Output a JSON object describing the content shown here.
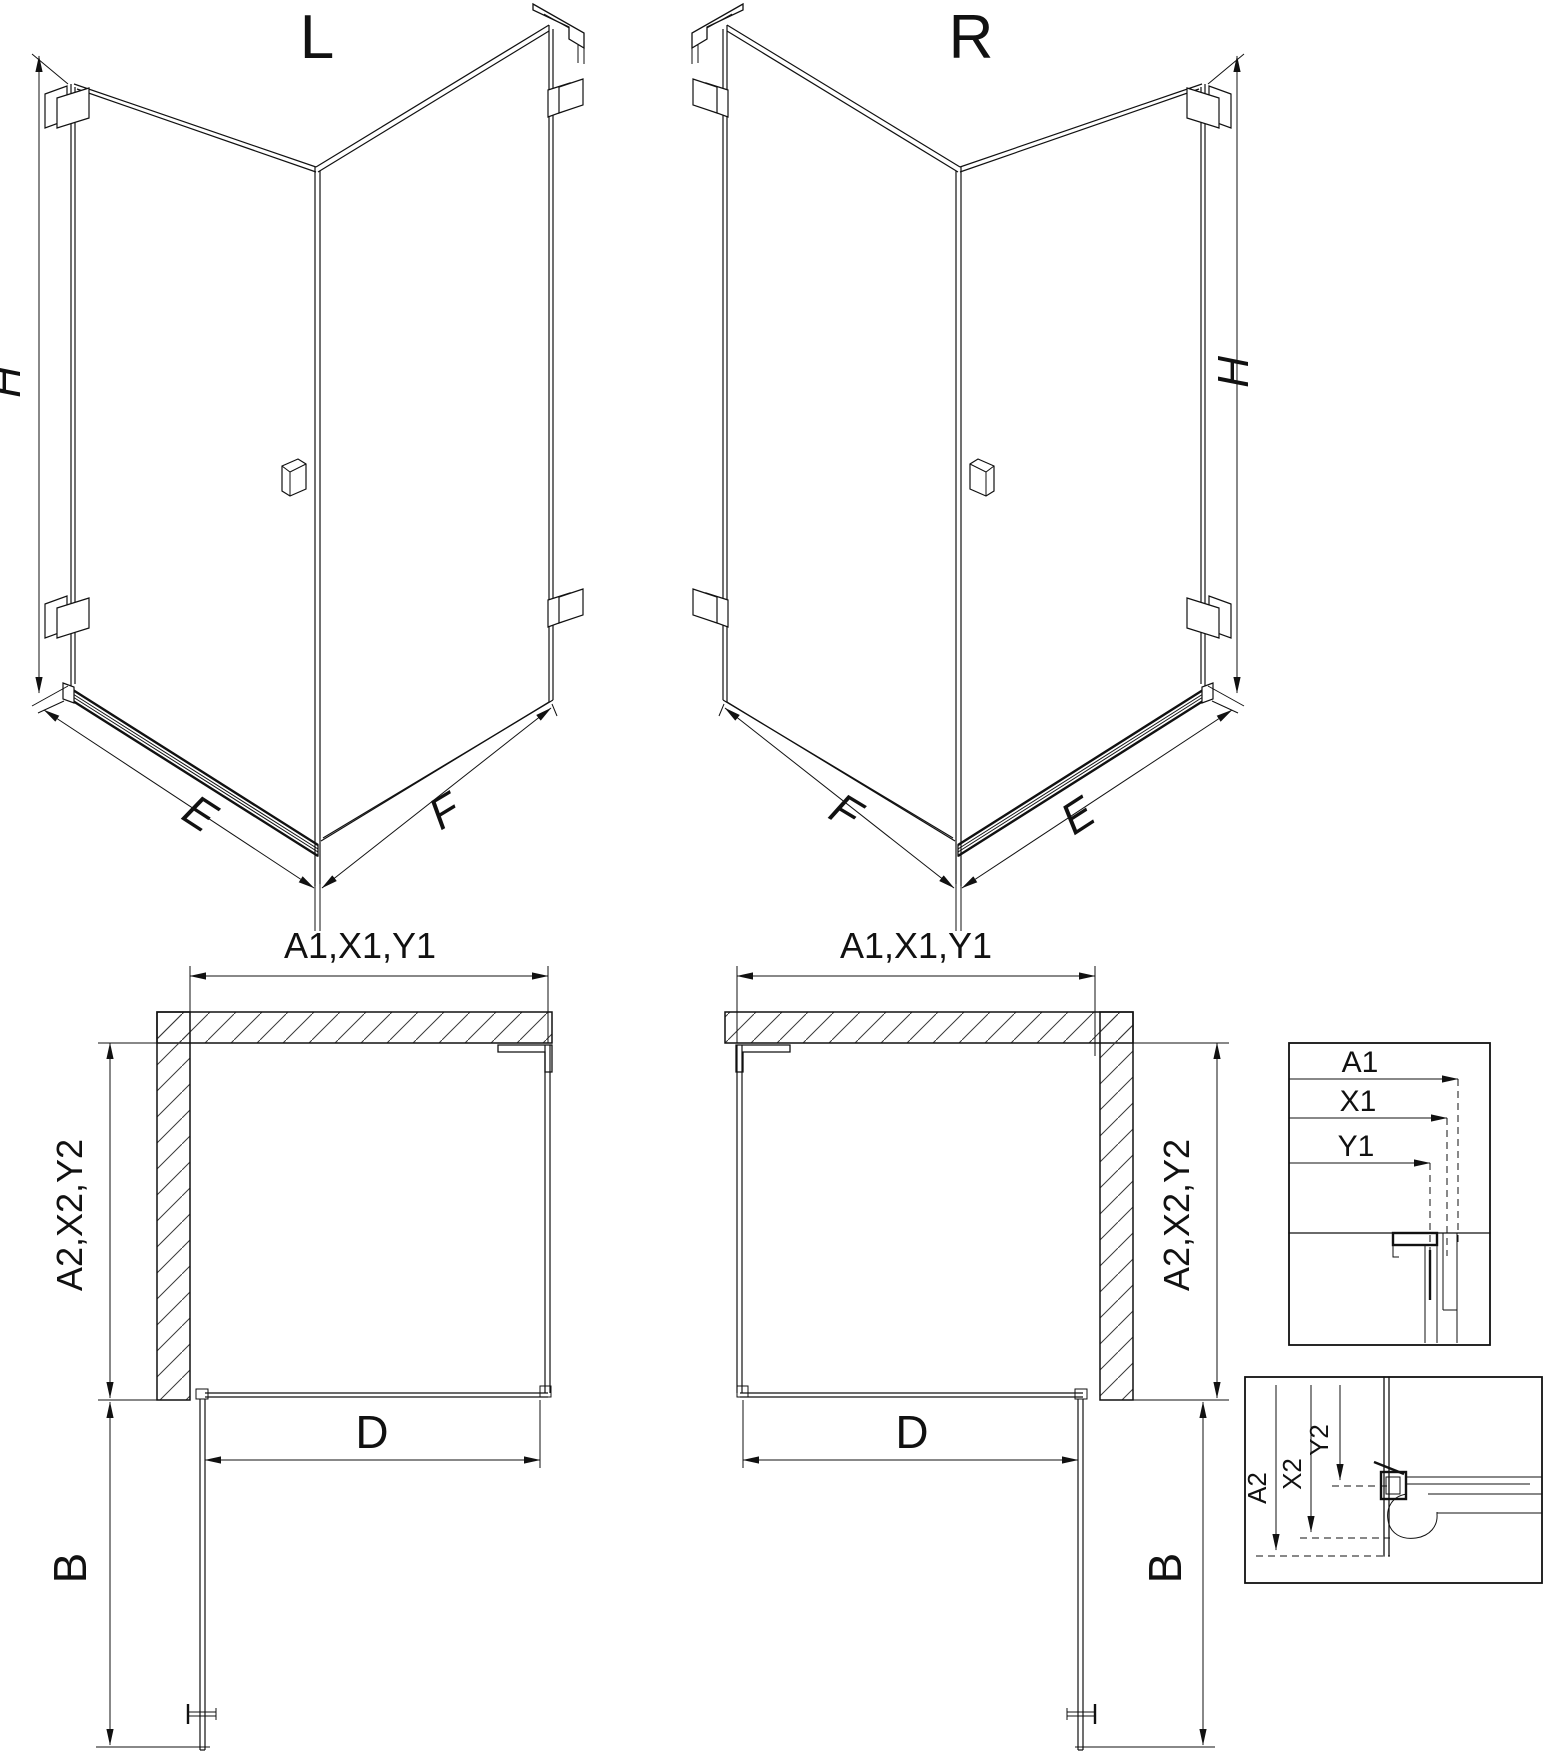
{
  "page": {
    "background": "#ffffff",
    "line_color": "#111111"
  },
  "iso_left": {
    "title": "L",
    "height_label": "H",
    "door_side_label": "E",
    "fixed_side_label": "F"
  },
  "iso_right": {
    "title": "R",
    "height_label": "H",
    "fixed_side_label": "F",
    "door_side_label": "E"
  },
  "plan_left": {
    "top_dim": "A1,X1,Y1",
    "side_dim": "A2,X2,Y2",
    "door_width_dim": "D",
    "door_swing_dim": "B"
  },
  "plan_right": {
    "top_dim": "A1,X1,Y1",
    "side_dim": "A2,X2,Y2",
    "door_width_dim": "D",
    "door_swing_dim": "B"
  },
  "detail_width": {
    "labels": [
      "A1",
      "X1",
      "Y1"
    ]
  },
  "detail_depth": {
    "labels": [
      "A2",
      "X2",
      "Y2"
    ]
  }
}
